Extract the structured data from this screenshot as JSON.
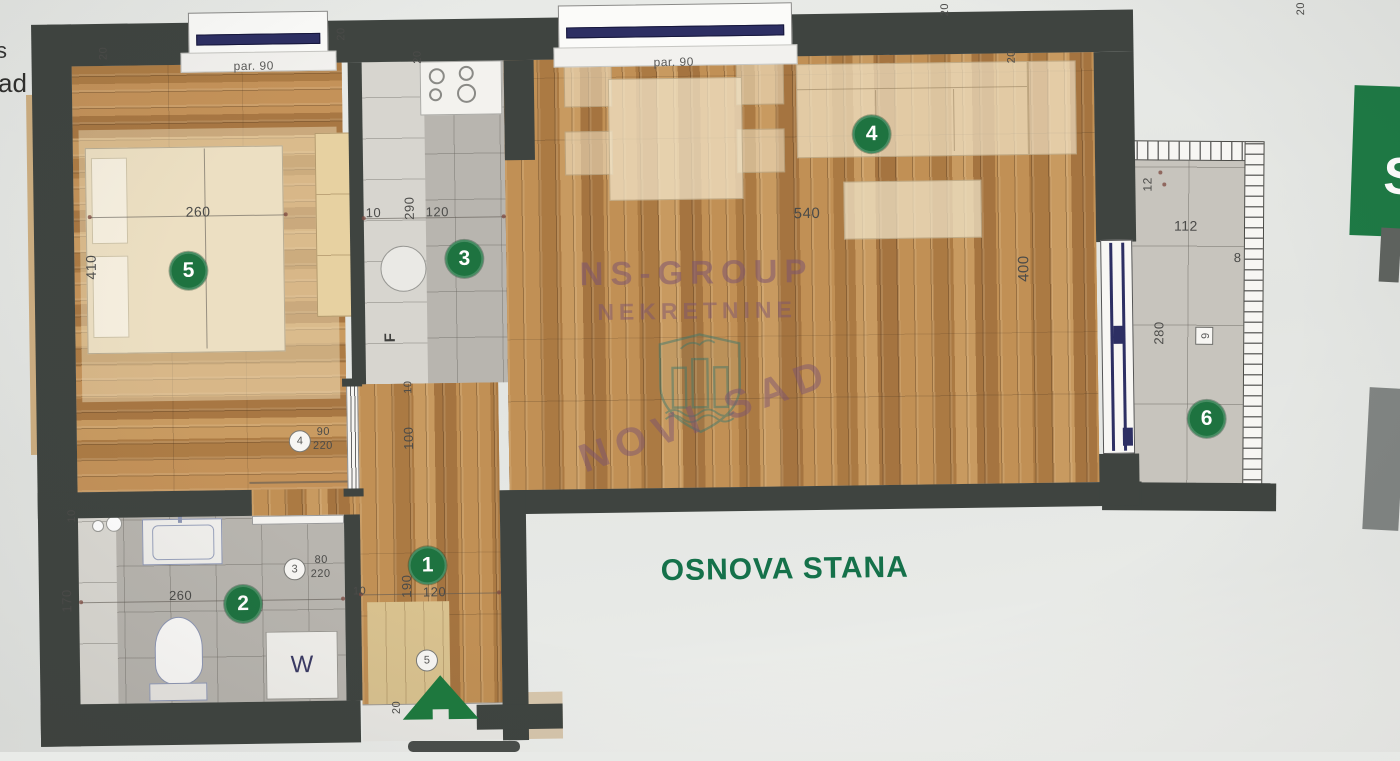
{
  "title": "OSNOVA STANA",
  "watermark": {
    "company": "NS-GROUP",
    "type": "NEKRETNINE",
    "city": "NOVI SAD"
  },
  "windows": {
    "bedroom_label": "par. 90",
    "living_label": "par. 90"
  },
  "labels": {
    "fridge": "F",
    "washer": "W"
  },
  "room_numbers": {
    "hallway": "1",
    "bathroom": "2",
    "kitchen": "3",
    "living": "4",
    "bedroom": "5",
    "terrace": "6"
  },
  "dims": {
    "d20": "20",
    "bedroom_width": "260",
    "bedroom_length": "410",
    "kitchen_offset": "10",
    "kitchen_length": "290",
    "kitchen_width": "120",
    "living_width": "540",
    "living_length": "400",
    "bath_depth": "170",
    "bath_width": "260",
    "bath_offset": "10",
    "hall_offset": "10",
    "hall_length": "190",
    "hall_width": "120",
    "hall_corridor": "100",
    "hall_corridor_offset": "10",
    "terrace_width": "112",
    "terrace_depth": "280",
    "terrace_rail": "12",
    "terrace_edge": "8"
  },
  "door_markers": {
    "bathroom": {
      "num": "3",
      "w": "80",
      "h": "220"
    },
    "bedroom": {
      "num": "4",
      "w": "90",
      "h": "220"
    },
    "entrance": {
      "num": "5"
    },
    "terrace": {
      "num": "6"
    }
  },
  "edge_fragments": {
    "left_top": "s",
    "left_mid": "ad",
    "right_letter": "S"
  },
  "colors": {
    "accent_green": "#1e7340",
    "title_green": "#15714a",
    "watermark_purple": "#7e5370",
    "wall": "#3f4440"
  }
}
